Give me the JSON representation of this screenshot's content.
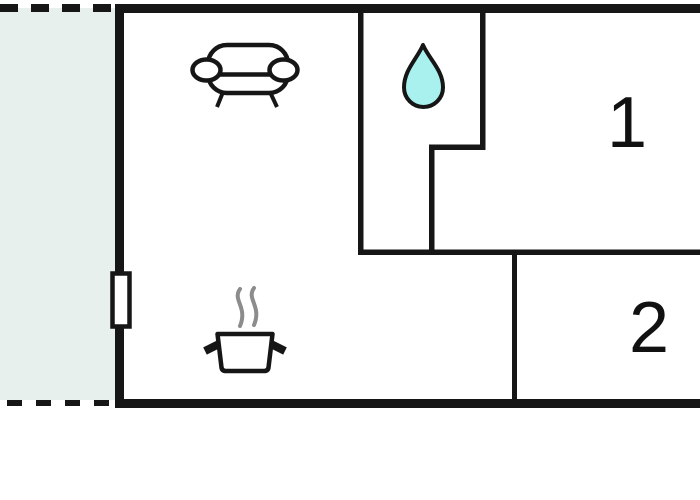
{
  "floor_plan": {
    "rooms": {
      "bedroom_1": {
        "label": "1"
      },
      "bedroom_2": {
        "label": "2"
      },
      "living_kitchen": {
        "icons": [
          "sofa-icon",
          "cooking-pot-icon",
          "steam-icon"
        ]
      },
      "bathroom": {
        "icons": [
          "water-drop-icon"
        ]
      },
      "terrace": {
        "icons": []
      }
    },
    "markers": {
      "window": "window-marker"
    },
    "colors": {
      "wall": "#161616",
      "terrace_fill": "#e8f0ee",
      "water_drop_fill": "#a9f1ee",
      "steam": "#8c8c8c",
      "background": "#ffffff"
    }
  }
}
